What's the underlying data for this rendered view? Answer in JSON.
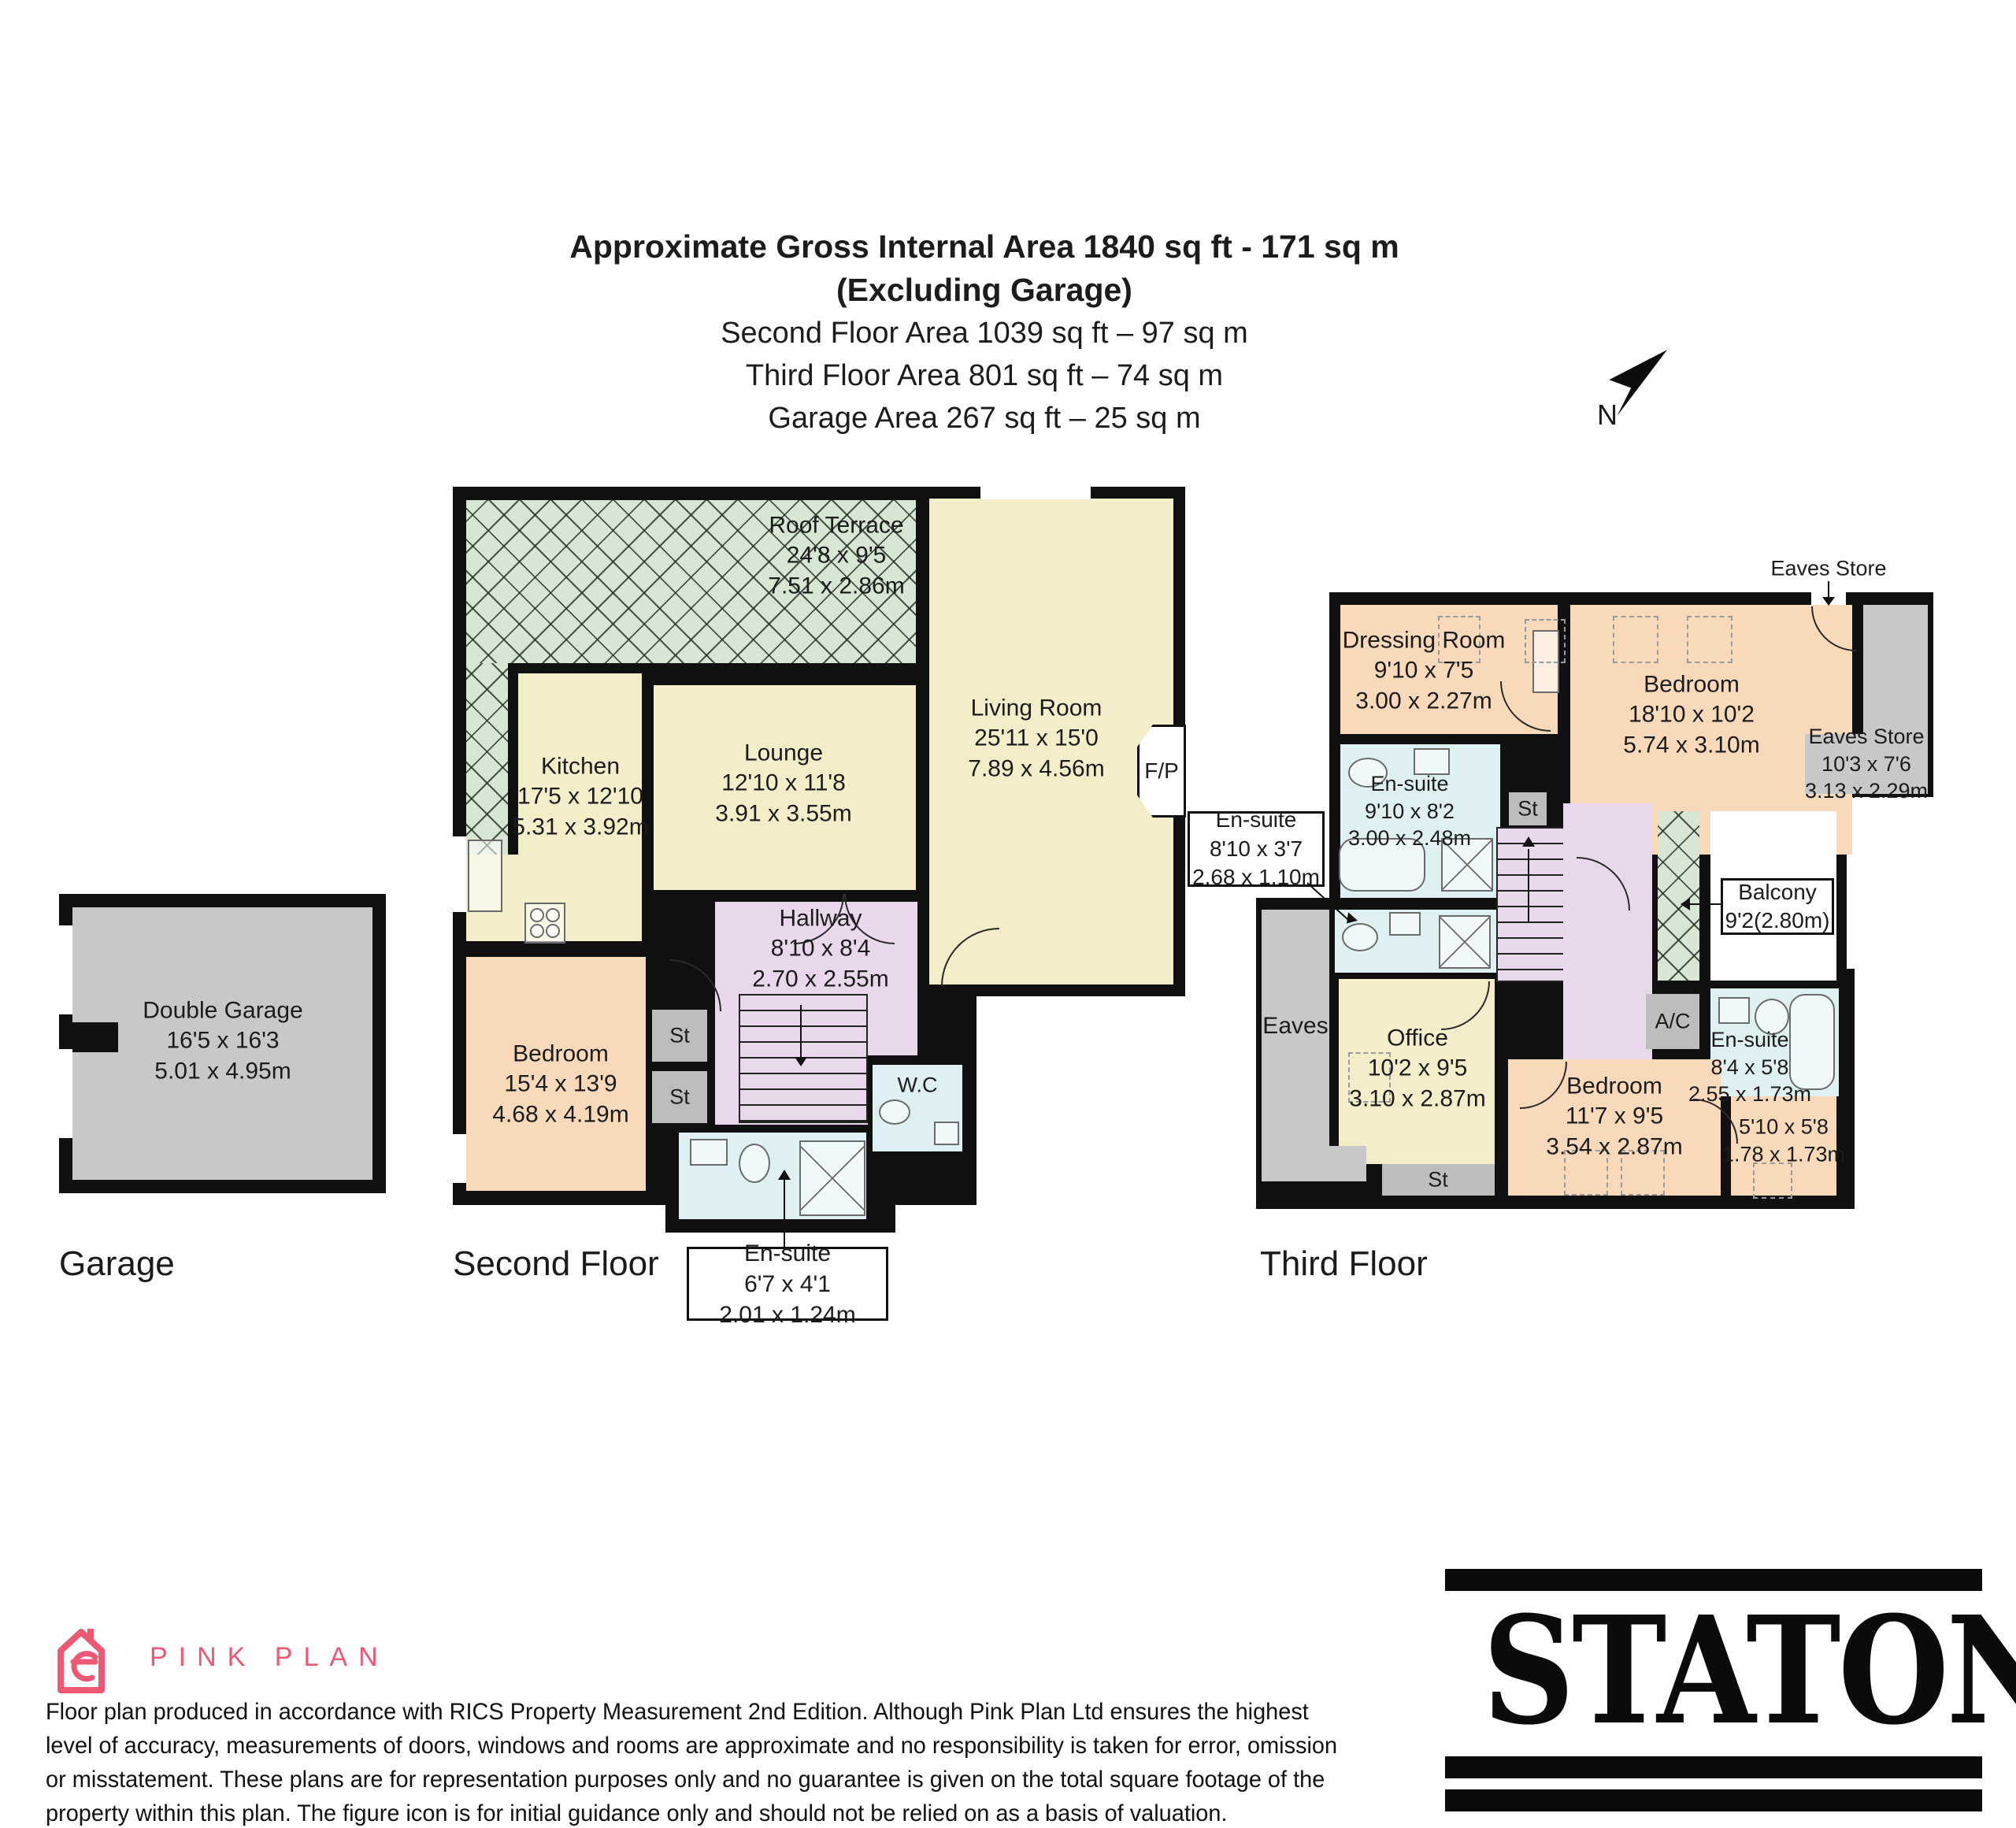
{
  "header": {
    "title_line1": "Approximate Gross Internal Area 1840 sq ft - 171 sq m",
    "title_line2": "(Excluding Garage)",
    "area_lines": [
      "Second Floor Area 1039 sq ft – 97 sq m",
      "Third Floor Area 801 sq ft – 74 sq m",
      "Garage Area 267 sq ft – 25 sq m"
    ]
  },
  "compass": {
    "north_label": "N"
  },
  "garage": {
    "caption": "Garage",
    "room": {
      "name": "Double Garage",
      "imp": "16'5 x 16'3",
      "met": "5.01 x 4.95m"
    }
  },
  "second": {
    "caption": "Second Floor",
    "rooms": {
      "terrace": {
        "name": "Roof Terrace",
        "imp": "24'8 x 9'5",
        "met": "7.51 x 2.86m"
      },
      "kitchen": {
        "name": "Kitchen",
        "imp": "17'5 x 12'10",
        "met": "5.31 x 3.92m"
      },
      "lounge": {
        "name": "Lounge",
        "imp": "12'10 x 11'8",
        "met": "3.91 x 3.55m"
      },
      "living": {
        "name": "Living Room",
        "imp": "25'11 x 15'0",
        "met": "7.89 x 4.56m"
      },
      "hallway": {
        "name": "Hallway",
        "imp": "8'10 x 8'4",
        "met": "2.70 x 2.55m"
      },
      "bedroom": {
        "name": "Bedroom",
        "imp": "15'4 x 13'9",
        "met": "4.68 x 4.19m"
      }
    },
    "small": {
      "st1": "St",
      "st2": "St",
      "wc": "W.C",
      "fp": "F/P"
    },
    "ensuite_callout": {
      "name": "En-suite",
      "imp": "6'7 x 4'1",
      "met": "2.01 x 1.24m"
    }
  },
  "third": {
    "caption": "Third Floor",
    "rooms": {
      "dressing": {
        "name": "Dressing Room",
        "imp": "9'10 x 7'5",
        "met": "3.00 x 2.27m"
      },
      "bedroom1": {
        "name": "Bedroom",
        "imp": "18'10 x 10'2",
        "met": "5.74 x 3.10m"
      },
      "eaves_store": {
        "name": "Eaves Store",
        "imp": "10'3 x 7'6",
        "met": "3.13 x 2.29m"
      },
      "ensuite1": {
        "name": "En-suite",
        "imp": "9'10 x 8'2",
        "met": "3.00 x 2.48m"
      },
      "office": {
        "name": "Office",
        "imp": "10'2 x 9'5",
        "met": "3.10 x 2.87m"
      },
      "bedroom2": {
        "name": "Bedroom",
        "imp": "11'7 x 9'5",
        "met": "3.54 x 2.87m"
      },
      "closet": {
        "imp": "5'10 x 5'8",
        "met": "1.78 x 1.73m"
      }
    },
    "small": {
      "st1": "St",
      "st2": "St",
      "ac": "A/C",
      "eaves": "Eaves"
    },
    "eaves_store_pointer": "Eaves Store",
    "ensuite_callout": {
      "name": "En-suite",
      "imp": "8'10 x 3'7",
      "met": "2.68 x 1.10m"
    },
    "balcony_callout": {
      "name": "Balcony",
      "dim": "9'2(2.80m)"
    }
  },
  "footer": {
    "brand": "PINK PLAN",
    "agent": "STATONS",
    "disclaimer": [
      "Floor plan produced in accordance with RICS Property Measurement 2nd Edition. Although Pink Plan Ltd ensures the highest",
      "level of accuracy, measurements of doors, windows and rooms are approximate and no responsibility is taken for error, omission",
      "or misstatement. These plans are for representation purposes only and no guarantee is given on the total square footage of the",
      "property within this plan. The figure icon is for initial guidance only and should not be relied on as a basis of valuation."
    ]
  }
}
